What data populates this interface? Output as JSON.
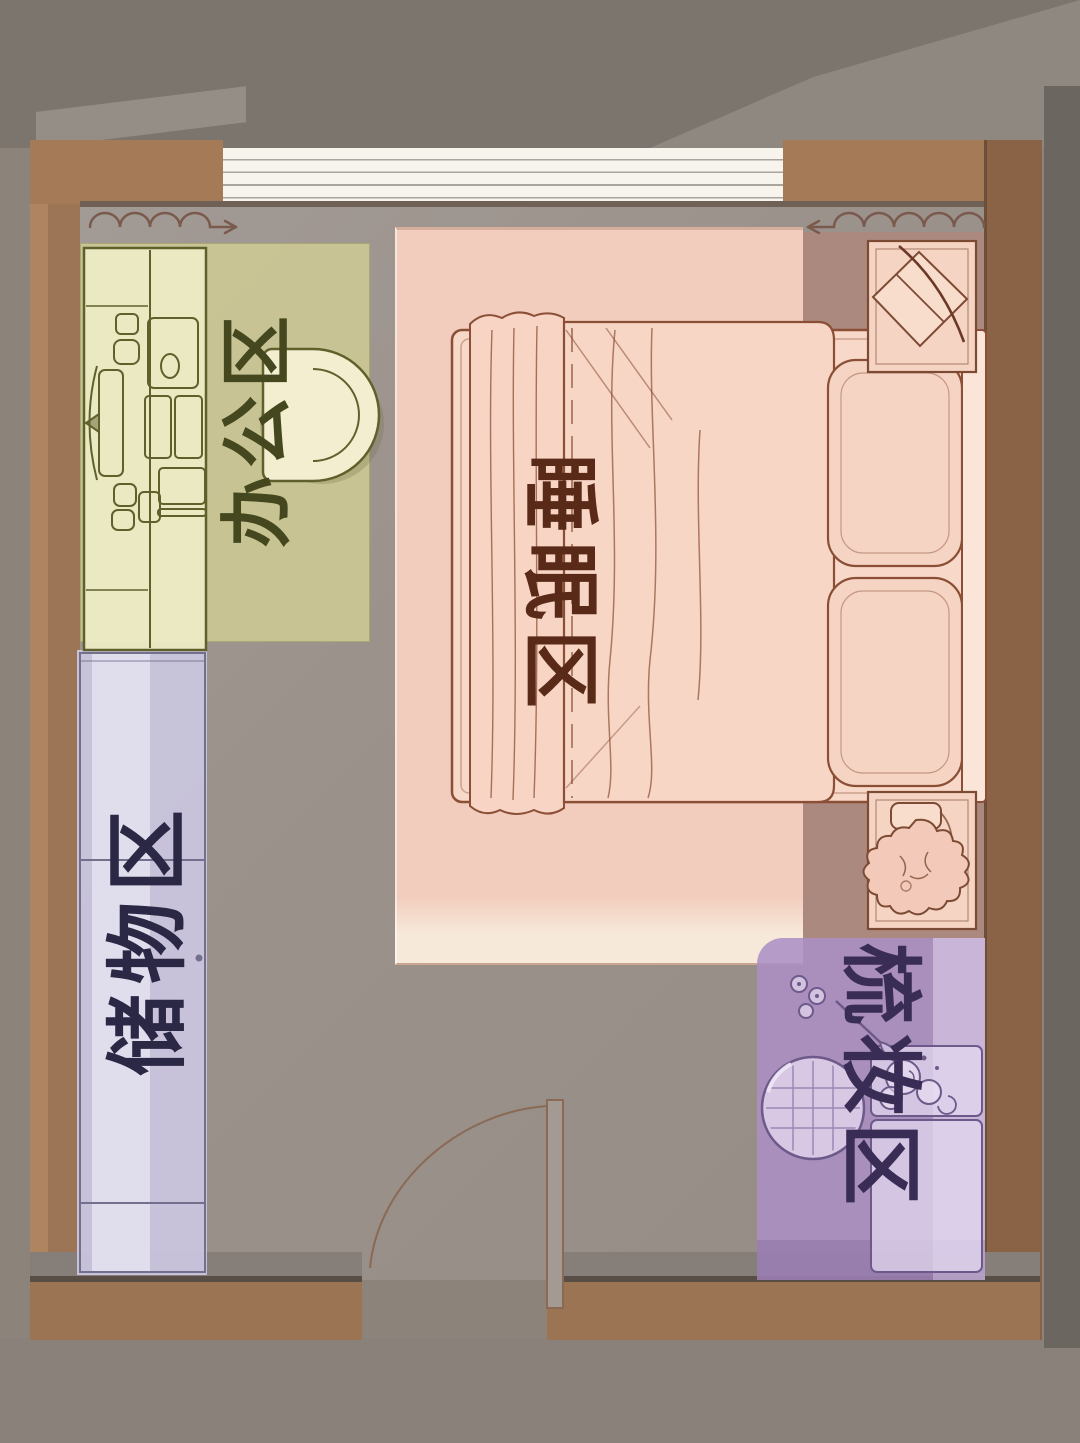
{
  "meta": {
    "description": "Hand-drawn bedroom floor plan divided into four functional zones",
    "language": "zh-CN"
  },
  "zones": {
    "office": {
      "label": "办公区",
      "area_color": "#cdc994",
      "label_color": "#45481e"
    },
    "sleeping": {
      "label": "睡眠区",
      "area_color": "#f6cfc0",
      "label_color": "#5a2a18"
    },
    "storage": {
      "label": "储物区",
      "area_color": "#c9c5dd",
      "label_color": "#2b2846"
    },
    "dressing": {
      "label": "梳妆区",
      "area_color": "#ac8fc4",
      "label_color": "#3a2d55"
    }
  },
  "palette": {
    "wall_brown": "#9c7456",
    "floor_gray": "#98908a",
    "background_gray": "#8c837b",
    "window_white": "#f7f4ee",
    "bed_pink": "#f8d8c8",
    "behind_curtain_mauve": "#ab897f",
    "line_brown": "#8a4f35",
    "line_olive": "#60602c",
    "line_purple": "#6d5a8a",
    "curtain_line": "#7b5a4e"
  },
  "furniture_icons": [
    "curtain-icon",
    "desk-icon",
    "monitor-icon",
    "office-chair-icon",
    "wardrobe-icon",
    "double-bed-icon",
    "pillow-icon",
    "nightstand-icon",
    "plant-icon",
    "door-swing-icon",
    "vanity-stool-icon",
    "vanity-table-icon",
    "perfume-icon",
    "hand-mirror-icon",
    "flowers-icon"
  ]
}
